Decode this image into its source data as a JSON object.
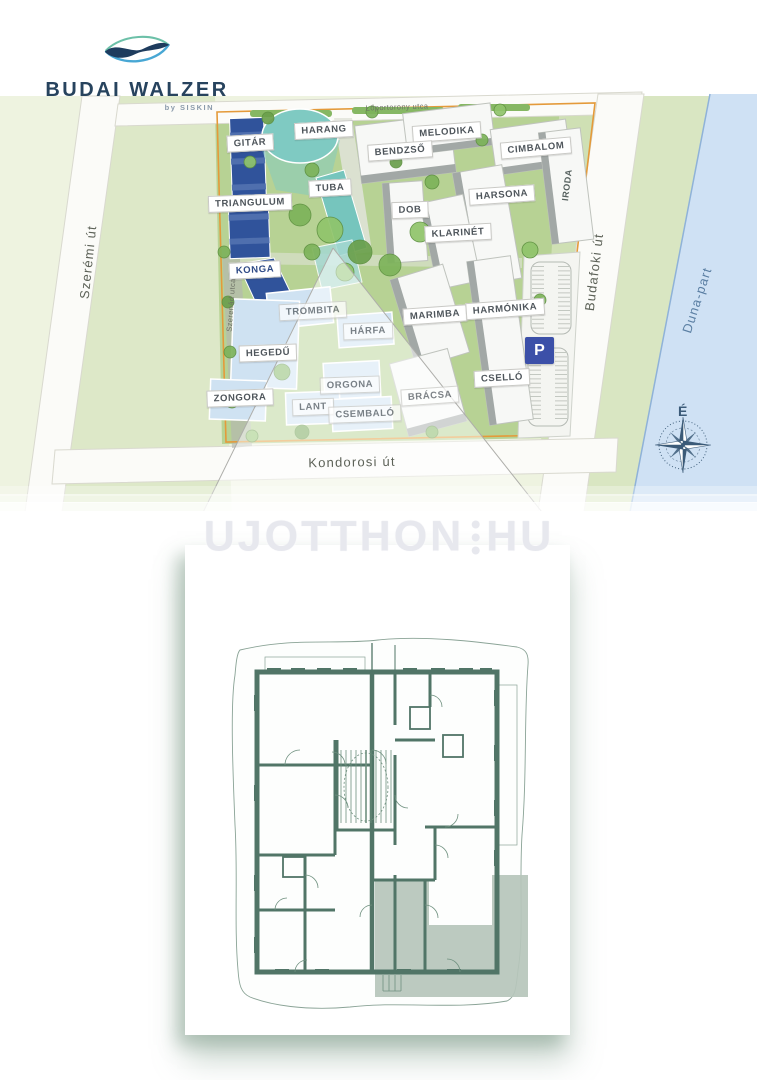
{
  "logo": {
    "title": "BUDAI WALZER",
    "subtitle": "by SISKIN"
  },
  "watermark": {
    "left": "UJOTTHON",
    "right": "HU"
  },
  "site_map": {
    "streets": {
      "szeremi": "Szerémi út",
      "loportorony": "Lőportorony utca",
      "szerenad": "Szerenád utca",
      "kondorosi": "Kondorosi út",
      "budafoki": "Budafoki út",
      "duna": "Duna-part"
    },
    "compass_north": "É",
    "parking_label": "P",
    "buildings": [
      {
        "label": "GITÁR"
      },
      {
        "label": "HARANG"
      },
      {
        "label": "MELODIKA"
      },
      {
        "label": "BENDZSŐ"
      },
      {
        "label": "CIMBALOM"
      },
      {
        "label": "TRIANGULUM"
      },
      {
        "label": "TUBA"
      },
      {
        "label": "HARSONA"
      },
      {
        "label": "DOB"
      },
      {
        "label": "KLARINÉT"
      },
      {
        "label": "IRODA"
      },
      {
        "label": "KONGA"
      },
      {
        "label": "TROMBITA"
      },
      {
        "label": "HÁRFA"
      },
      {
        "label": "MARIMBA"
      },
      {
        "label": "HARMÓNIKA"
      },
      {
        "label": "HEGEDŰ"
      },
      {
        "label": "CSELLÓ"
      },
      {
        "label": "ORGONA"
      },
      {
        "label": "ZONGORA"
      },
      {
        "label": "LANT"
      },
      {
        "label": "CSEMBALÓ"
      },
      {
        "label": "BRÁCSA"
      }
    ]
  },
  "colors": {
    "brand_navy": "#27435e",
    "building_blue": "#30539b",
    "building_teal": "#7fcac2",
    "building_lightblue": "#cfe2f2",
    "parking_blue": "#3c50a8",
    "boundary_orange": "#e49a3a",
    "water_blue": "#cfe1f4",
    "plan_wall_green": "#517567",
    "plan_highlight": "#b6c5bb"
  }
}
